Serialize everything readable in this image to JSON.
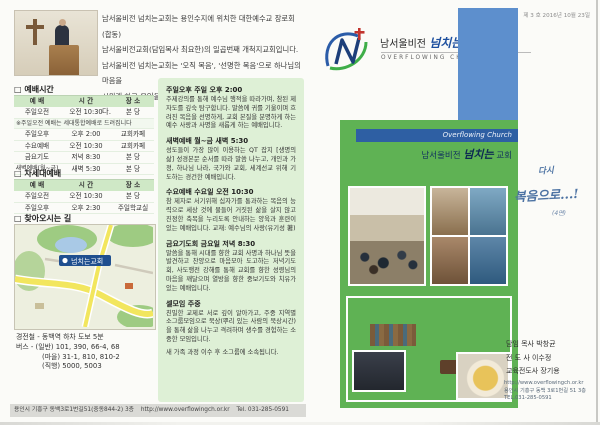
{
  "left": {
    "intro": {
      "lines": [
        "남서울비전 넘치는교회는 용인수지에 위치한 대한예수교 장로회(합동)",
        "남서울비전교회(담임목사 최요한)의 일곱번째 개척지교회입니다.",
        "남서울비전 넘치는교회는 '오직 복음', '선명한 복음'으로 하나님의 마음을",
        "시원케 하고 용인을 하나님의 도시로 만드는 비전을 가지고 있습니다."
      ]
    },
    "worship": {
      "title": "□ 예배시간",
      "headers": [
        "예 배",
        "시 간",
        "장 소"
      ],
      "note": "※주일오전 예배는 세대통합예배로 드려집니다",
      "rows": [
        [
          "주일오전",
          "오전 10:30",
          "본 당"
        ],
        [
          "주일오후",
          "오후 2:00",
          "교회카페"
        ],
        [
          "수요예배",
          "오전 10:30",
          "교회카페"
        ],
        [
          "금요기도",
          "저녁 8:30",
          "본 당"
        ],
        [
          "새벽예배(월~금)",
          "새벽 5:30",
          "본 당"
        ]
      ]
    },
    "nextgen": {
      "title": "□ 차세대예배",
      "headers": [
        "예 배",
        "시 간",
        "장 소"
      ],
      "rows": [
        [
          "주일오전",
          "오전 10:30",
          "본 당"
        ],
        [
          "주일오후",
          "오후 2:30",
          "주일학교실"
        ]
      ]
    },
    "directions": {
      "title": "□ 찾아오시는 길",
      "map_label": "넘치는교회",
      "lines": [
        "경전철 - 동백역 하차 도보 5분",
        "버스 - (일반) 101, 390, 66-4, 68",
        "(마을) 31-1, 810, 810-2",
        "(직행) 5000, 5003"
      ]
    },
    "footer": {
      "address": "용인시 기흥구 동백3로1번길51(중동844-2) 3층",
      "url": "http://www.overflowingch.or.kr",
      "tel": "Tel. 031-285-0591"
    }
  },
  "schedule": {
    "sections": [
      {
        "title": "주일오후 주일 오후 2:00",
        "body": "주제강의를 통해 예수님 행적을 따라가며, 참된 제자도를 깊숙 탐구합니다. 말씀에 귀를 기울이며 흐려진 복음을 선명하게, 교회 본질을 분명하게 하는 예수 사랑과 사명을 새롭게 하는 예배입니다."
      },
      {
        "title": "새벽예배 월~금 새벽 5:30",
        "body": "성도들이 가장 많이 이용하는 QT 잡지 [생명의 삶] 성경본문 순서를 따라 말씀 나누고, 개인과 가정, 하나님 나라, 국가와 교회, 세계선교 위해 기도하는 경건한 예배입니다."
      },
      {
        "title": "수요예배 수요일 오전 10:30",
        "body": "참 제자로 서기위해 십자가를 통과하는 복음의 능력으로 세상 것에 물들어 거짓된 삶을 살지 않고 진정한 축복을 누리도록 안내하는 양육과 훈련이 있는 예배입니다. 교재: 예수님의 사랑(유기성 著)"
      },
      {
        "title": "금요기도회 금요일 저녁 8:30",
        "body": "말씀을 통해 시대를 향한 교회 사명과 하나님 뜻을 발견하고 찬양으로 마음모아 도고하는 저녁기도회, 사도행전 강해를 통해 교회를 향한 성령님의 마음을 깨달으며 열방을 향한 중보기도와 치유가 있는 예배입니다."
      },
      {
        "title": "셀모임 주중",
        "body": "친밀한 교제로 서로 깊이 알아가고, 주중 지역별 소그룹모임으로 묵상(뿌리 있는 사람의 묵상시간)을 통해 삶을 나누고 격려하며 생수를 경험하는 소중한 모임입니다.",
        "note": "새 가족 과정 이수 후 소그룹에 소속됩니다."
      }
    ]
  },
  "right": {
    "issue": "제 3 호 2016년 10월 23일",
    "logo": {
      "name_pre": "남서울비전",
      "name_script": "넘치는",
      "name_post": "교회",
      "sub": "OVERFLOWING CHURCH"
    },
    "banner": {
      "strip": "Overflowing Church",
      "title_pre": "남서울비전",
      "title_script": "넘치는",
      "title_post": "교회"
    },
    "handwriting": {
      "line1": "다시",
      "line2": "복음으로...!",
      "note": "(4면)"
    },
    "staff": [
      "담임 목사 박창균",
      "전 도 사 이수정",
      "교육전도사 장기용"
    ],
    "contact": [
      "http://www.overflowingch.or.kr",
      "용인시 기흥구 동백 3로1번길 51 3층",
      "TEL.031-285-0591"
    ]
  },
  "colors": {
    "green_panel": "#5fb254",
    "schedule_box": "#def0d6",
    "table_header": "#cfe8c6",
    "blue_block": "#5d8fcd",
    "strip_blue": "#2e5fa3",
    "handwriting": "#4d73a3"
  }
}
